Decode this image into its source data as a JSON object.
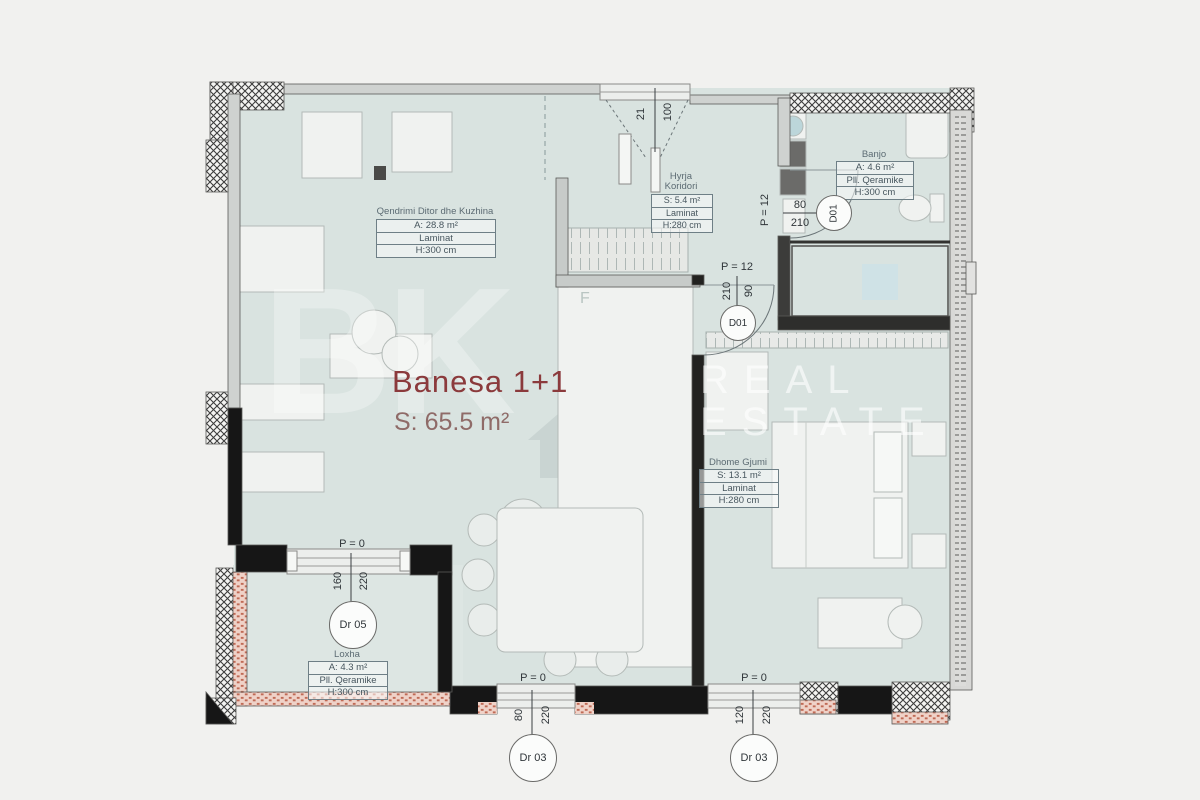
{
  "title": {
    "name": "Banesa 1+1",
    "area": "S: 65.5 m²"
  },
  "watermark": {
    "real": "REAL",
    "estate": "ESTATE",
    "monogram": "BK"
  },
  "rooms": [
    {
      "name": "Qendrimi Ditor dhe Kuzhina",
      "rows": [
        "A: 28.8 m²",
        "Laminat",
        "H:300 cm"
      ]
    },
    {
      "name": "Hyrja",
      "name2": "Koridori",
      "rows": [
        "S: 5.4 m²",
        "Laminat",
        "H:280 cm"
      ]
    },
    {
      "name": "Banjo",
      "rows": [
        "A: 4.6 m²",
        "Pll. Qeramike",
        "H:300 cm"
      ]
    },
    {
      "name": "Dhome Gjumi",
      "rows": [
        "S: 13.1 m²",
        "Laminat",
        "H:280 cm"
      ]
    },
    {
      "name": "Loxha",
      "rows": [
        "A: 4.3 m²",
        "Pll. Qeramike",
        "H:300 cm"
      ]
    }
  ],
  "doors": {
    "entrance": {
      "width": "100",
      "height": "21"
    },
    "bath": {
      "p": "P = 12",
      "w": "80",
      "h": "210",
      "tag": "D01"
    },
    "bedroom": {
      "p": "P = 12",
      "w": "90",
      "h": "210",
      "tag": "D01"
    },
    "balcony": {
      "p": "P = 0",
      "w": "160",
      "h": "220",
      "tag": "Dr 05"
    },
    "terrace1": {
      "p": "P = 0",
      "w": "80",
      "h": "220",
      "tag": "Dr 03"
    },
    "terrace2": {
      "p": "P = 0",
      "w": "120",
      "h": "220",
      "tag": "Dr 03"
    }
  },
  "furniture": {
    "tall_unit_label": "F"
  },
  "colors": {
    "title": "#8b3a3c",
    "subtitle": "#8f6b68",
    "floor": "#d9e3e0",
    "brick": "#c06a55"
  }
}
